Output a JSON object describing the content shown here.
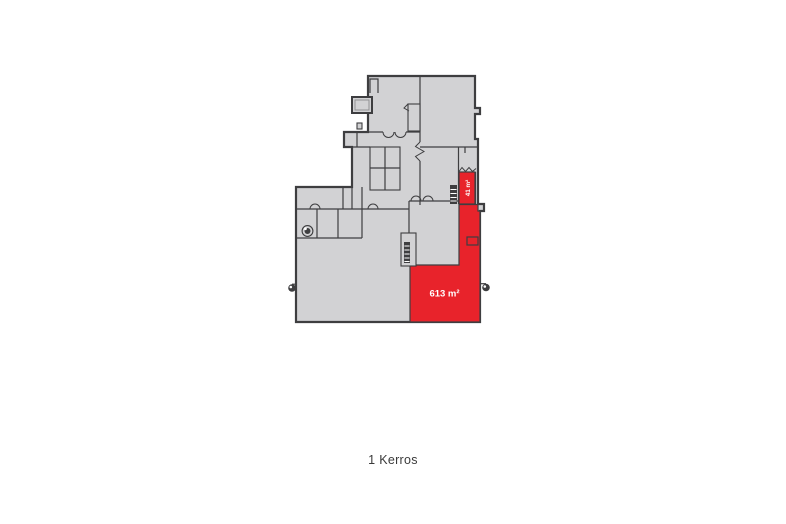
{
  "floorplan": {
    "floor_label": "1 Kerros",
    "areas": [
      {
        "id": "unit-41",
        "label": "41 m²",
        "highlighted": true
      },
      {
        "id": "unit-613",
        "label": "613 m²",
        "highlighted": true
      }
    ],
    "icons": {
      "stairs": "hatched-bar",
      "spiral_staircase": "dark-circle-swirl",
      "section_marker": "dark-circle-handle"
    },
    "colors": {
      "highlight": "#e8232b",
      "fill": "#d2d2d4",
      "wall": "#3e3e40",
      "label_text": "#3a3a3a",
      "area_text": "#ffffff"
    }
  }
}
